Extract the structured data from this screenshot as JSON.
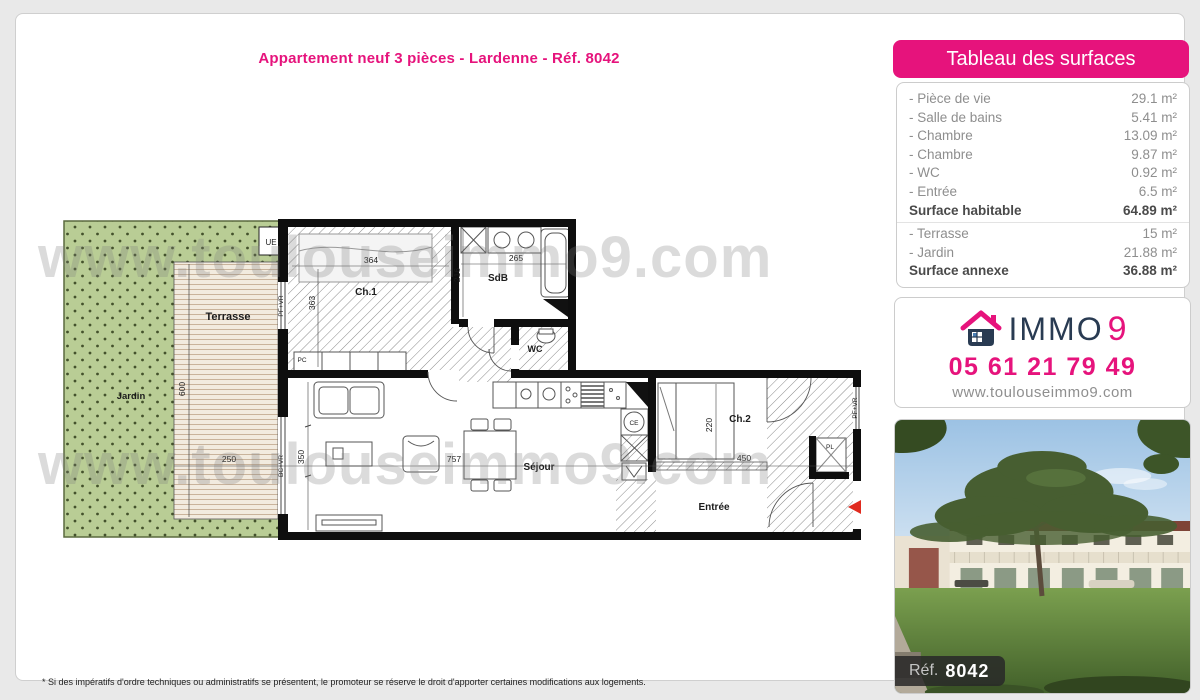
{
  "page": {
    "title": "Appartement neuf 3 pièces - Lardenne - Réf. 8042",
    "footnote": "* Si des impératifs d'ordre techniques ou administratifs se présentent, le promoteur se réserve le droit d'apporter certaines modifications aux logements."
  },
  "watermark": "www.toulouseimmo9.com",
  "surfaces": {
    "header": "Tableau des surfaces",
    "rows": [
      {
        "label": "- Pièce de vie",
        "value": "29.1 m²",
        "bold": false,
        "sep": false
      },
      {
        "label": "- Salle de bains",
        "value": "5.41 m²",
        "bold": false,
        "sep": false
      },
      {
        "label": "- Chambre",
        "value": "13.09 m²",
        "bold": false,
        "sep": false
      },
      {
        "label": "- Chambre",
        "value": "9.87 m²",
        "bold": false,
        "sep": false
      },
      {
        "label": "- WC",
        "value": "0.92 m²",
        "bold": false,
        "sep": false
      },
      {
        "label": "- Entrée",
        "value": "6.5 m²",
        "bold": false,
        "sep": false
      },
      {
        "label": "Surface habitable",
        "value": "64.89 m²",
        "bold": true,
        "sep": true
      },
      {
        "label": "- Terrasse",
        "value": "15 m²",
        "bold": false,
        "sep": false
      },
      {
        "label": "- Jardin",
        "value": "21.88 m²",
        "bold": false,
        "sep": false
      },
      {
        "label": "Surface annexe",
        "value": "36.88 m²",
        "bold": true,
        "sep": false
      }
    ]
  },
  "contact": {
    "brand_immo": "IMMO",
    "brand_9": "9",
    "phone": "05 61 21 79 49",
    "website": "www.toulouseimmo9.com"
  },
  "photo": {
    "ref_label": "Réf.",
    "ref_value": "8042"
  },
  "plan": {
    "rooms": {
      "terrasse": "Terrasse",
      "jardin": "Jardin",
      "ch1": "Ch.1",
      "sdb": "SdB",
      "wc": "WC",
      "sejour": "Séjour",
      "ch2": "Ch.2",
      "entree": "Entrée"
    },
    "dims": {
      "d600": "600",
      "d250": "250",
      "d364": "364",
      "d363": "363",
      "d265": "265",
      "d216": "216",
      "d757": "757",
      "d350": "350",
      "d220": "220",
      "d450": "450"
    },
    "tags": {
      "ue": "UE",
      "pc": "PC",
      "ce": "CE",
      "pl": "PL",
      "pf_vr": "PF+VR",
      "bc_vr": "BC+VR"
    }
  },
  "colors": {
    "pink": "#e6137c",
    "navy": "#293b52"
  }
}
